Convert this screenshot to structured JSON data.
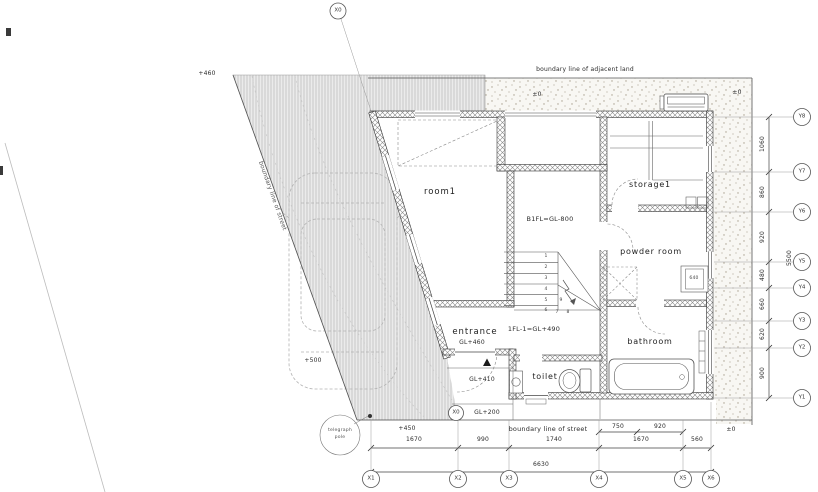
{
  "boundaries": {
    "adjacent_land": "boundary line of adjacent land",
    "street_bottom": "boundary line of street",
    "street_diagonal": "boundary line of street",
    "telegraph_pole": [
      "telegraph",
      "pole"
    ]
  },
  "rooms": {
    "room1": "room1",
    "storage1": "storage1",
    "powder_room": "powder room",
    "entrance": "entrance",
    "toilet": "toilet",
    "bathroom": "bathroom"
  },
  "levels": {
    "b1fl": "B1FL=GL-800",
    "fl1": "1FL-1=GL+490",
    "gl460": "GL+460",
    "gl410": "GL+410",
    "gl200": "GL+200",
    "site_pm0_top_left": "±0",
    "site_pm0_top_right": "±0",
    "site_pm0_bottom_right": "±0",
    "site_plus460": "+460",
    "site_plus500": "+500",
    "site_plus450": "+450"
  },
  "fixtures": {
    "basin_width": "640"
  },
  "stairs": {
    "steps": [
      "1",
      "2",
      "3",
      "4",
      "5",
      "6",
      "7",
      "8",
      "9"
    ]
  },
  "grid": {
    "x_top": "X0",
    "x_bottom_aux": "X0",
    "x": [
      "X1",
      "X2",
      "X3",
      "X4",
      "X5",
      "X6"
    ],
    "y": [
      "Y8",
      "Y7",
      "Y6",
      "Y5",
      "Y4",
      "Y3",
      "Y2",
      "Y1"
    ]
  },
  "dimensions": {
    "bottom": [
      "1670",
      "990",
      "1740",
      "1670",
      "560"
    ],
    "bottom_total": "6630",
    "bottom_sub": [
      "750",
      "920"
    ],
    "right": [
      "1060",
      "860",
      "920",
      "480",
      "660",
      "620",
      "900"
    ],
    "right_total": "5500"
  },
  "colors": {
    "wall_line": "#333333",
    "hatch": "#c9c9c9",
    "stipple_dot": "#a89f8e"
  }
}
